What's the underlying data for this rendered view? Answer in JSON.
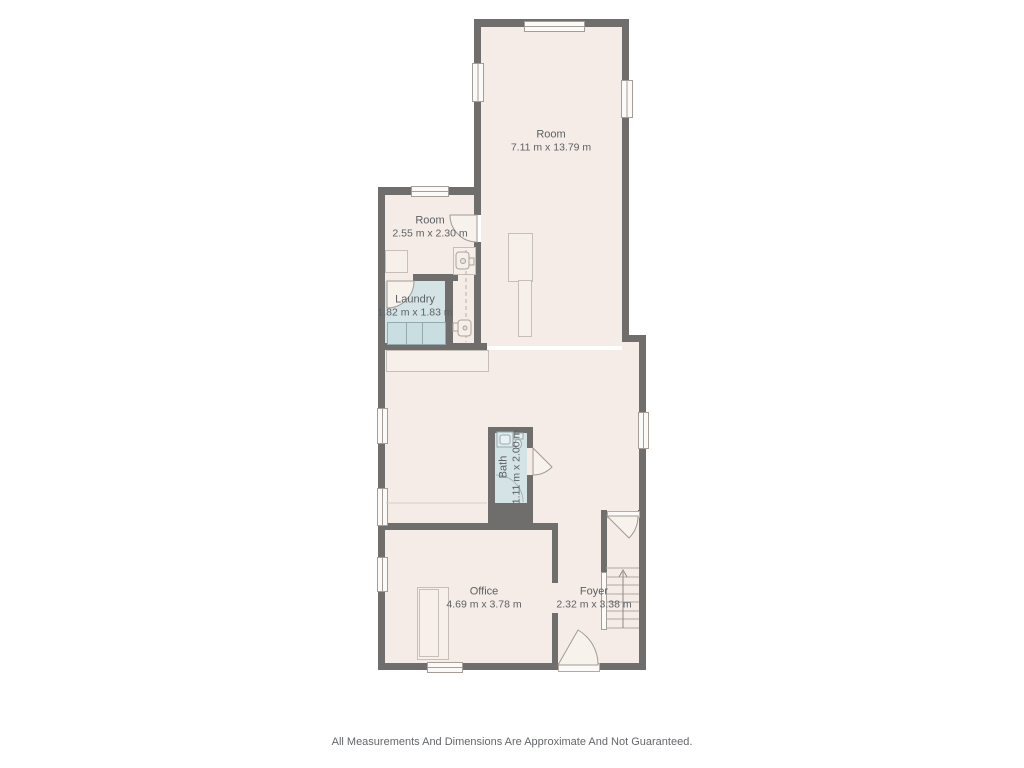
{
  "plan": {
    "rooms": [
      {
        "name": "Room",
        "dimensions": "7.11 m x 13.79 m"
      },
      {
        "name": "Room",
        "dimensions": "2.55 m x 2.30 m"
      },
      {
        "name": "Laundry",
        "dimensions": "1.82 m x 1.83 m"
      },
      {
        "name": "Bath",
        "dimensions": "1.11 m x 2.00 m"
      },
      {
        "name": "Office",
        "dimensions": "4.69 m x 3.78 m"
      },
      {
        "name": "Foyer",
        "dimensions": "2.32 m x 3.38 m"
      }
    ],
    "disclaimer": "All Measurements And Dimensions Are Approximate And Not Guaranteed.",
    "colors": {
      "wall": "#6f6e6c",
      "floor": "#f5ece7",
      "wet_room": "#d4e4e6",
      "background": "#ffffff"
    }
  }
}
